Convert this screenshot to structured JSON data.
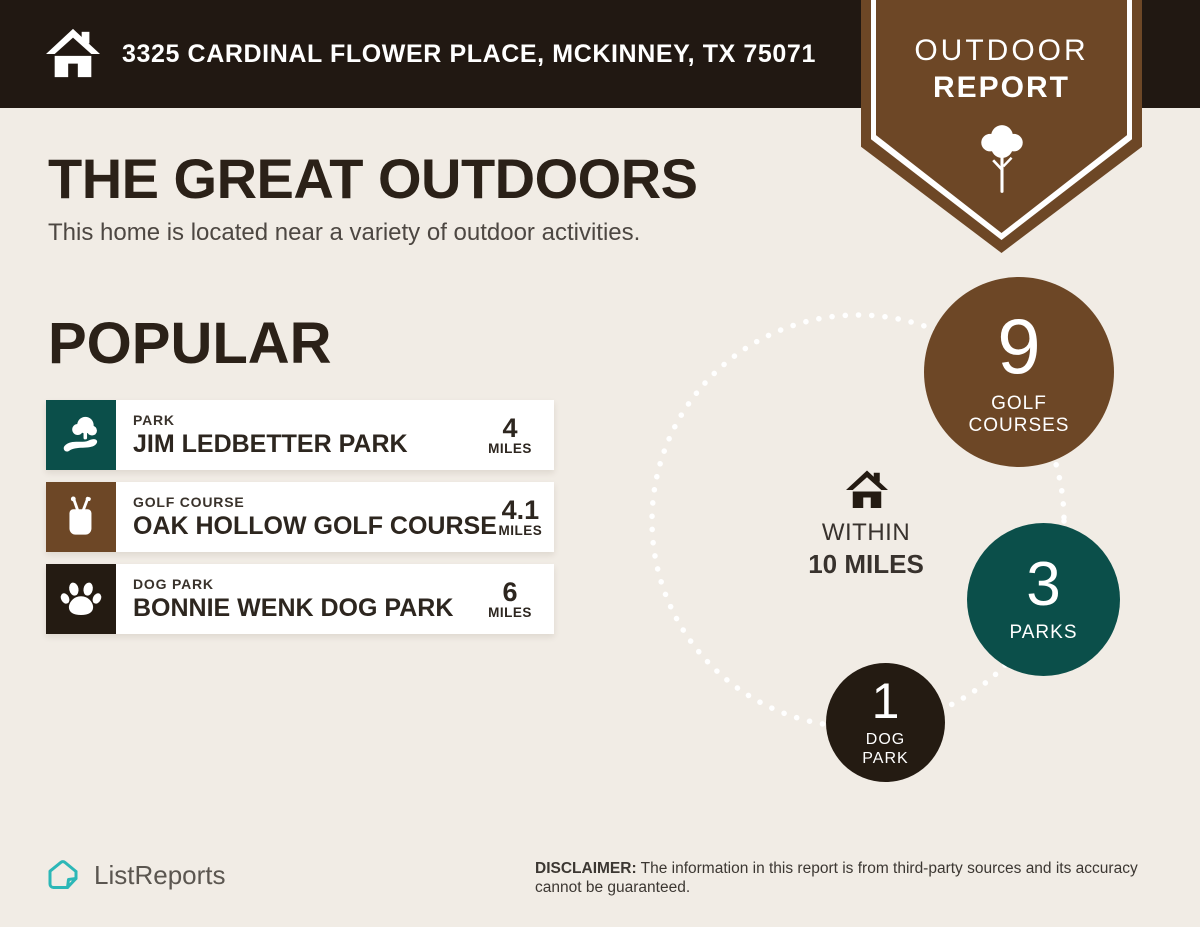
{
  "colors": {
    "header_bg": "#211812",
    "page_bg": "#f1ece5",
    "brown": "#6d4726",
    "teal": "#0b4f4a",
    "black": "#241b12",
    "logo_teal": "#2cb7b7"
  },
  "header": {
    "address": "3325 CARDINAL FLOWER PLACE, MCKINNEY, TX 75071"
  },
  "badge": {
    "line1": "OUTDOOR",
    "line2": "REPORT"
  },
  "hero": {
    "title": "THE GREAT OUTDOORS",
    "subtitle": "This home is located near a variety of outdoor activities."
  },
  "popular": {
    "heading": "POPULAR",
    "items": [
      {
        "category": "PARK",
        "name": "JIM LEDBETTER PARK",
        "distance": "4",
        "unit": "MILES",
        "icon": "park-icon"
      },
      {
        "category": "GOLF COURSE",
        "name": "OAK HOLLOW GOLF COURSE",
        "distance": "4.1",
        "unit": "MILES",
        "icon": "golf-bag-icon"
      },
      {
        "category": "DOG PARK",
        "name": "BONNIE WENK DOG PARK",
        "distance": "6",
        "unit": "MILES",
        "icon": "paw-icon"
      }
    ]
  },
  "radius_chart": {
    "center_icon": "home-icon",
    "center_line1": "WITHIN",
    "center_line2": "10 MILES",
    "bubbles": [
      {
        "value": "9",
        "label": "GOLF COURSES"
      },
      {
        "value": "3",
        "label": "PARKS"
      },
      {
        "value": "1",
        "label": "DOG PARK"
      }
    ]
  },
  "footer": {
    "brand": "ListReports",
    "disclaimer_label": "DISCLAIMER:",
    "disclaimer_text": " The information in this report is from third-party sources and its accuracy cannot be guaranteed."
  }
}
